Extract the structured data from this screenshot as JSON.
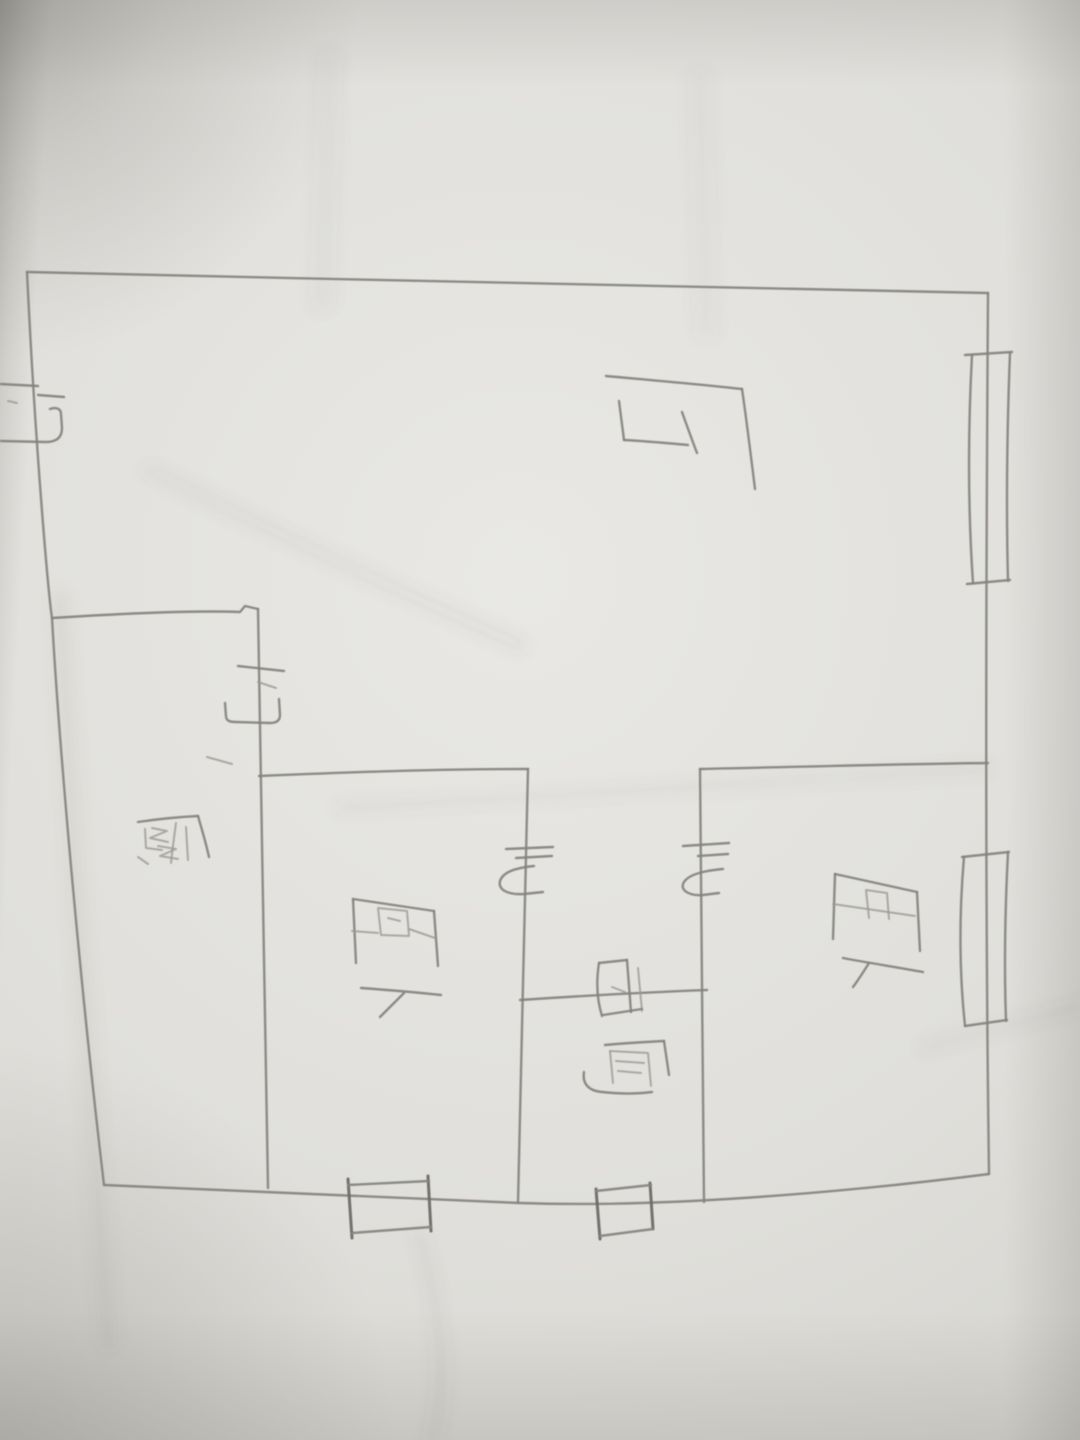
{
  "photo": {
    "type": "hand-drawn pencil floor plan photographed on white paper",
    "orientation_note": "handwritten room labels are rotated 90 degrees clockwise",
    "paper_color": "#dcdbd7",
    "pencil_color": "#84837e"
  },
  "floor_plan": {
    "rooms": [
      {
        "id": "hall",
        "label": "厅"
      },
      {
        "id": "kitchen",
        "label": "厨"
      },
      {
        "id": "bedroom-left",
        "label": "卧"
      },
      {
        "id": "bathroom",
        "label": "卫厕",
        "label_chars": [
          "卫",
          "厕"
        ]
      },
      {
        "id": "bedroom-right",
        "label": "卧"
      }
    ],
    "door_symbols": [
      {
        "id": "entry-door",
        "wall": "left-outer-wall"
      },
      {
        "id": "kitchen-door",
        "wall": "kitchen-divider-wall"
      },
      {
        "id": "bedroom-left-door",
        "wall": "bedroom-left-divider-wall"
      },
      {
        "id": "bedroom-right-door",
        "wall": "bedroom-right-divider-wall"
      }
    ],
    "window_symbols": [
      {
        "id": "hall-right-window",
        "wall": "right-outer-wall"
      },
      {
        "id": "bedroom-right-window",
        "wall": "right-outer-wall"
      },
      {
        "id": "bedroom-left-bottom-window",
        "wall": "bottom-outer-wall"
      },
      {
        "id": "bathroom-bottom-window",
        "wall": "bottom-outer-wall"
      }
    ]
  }
}
